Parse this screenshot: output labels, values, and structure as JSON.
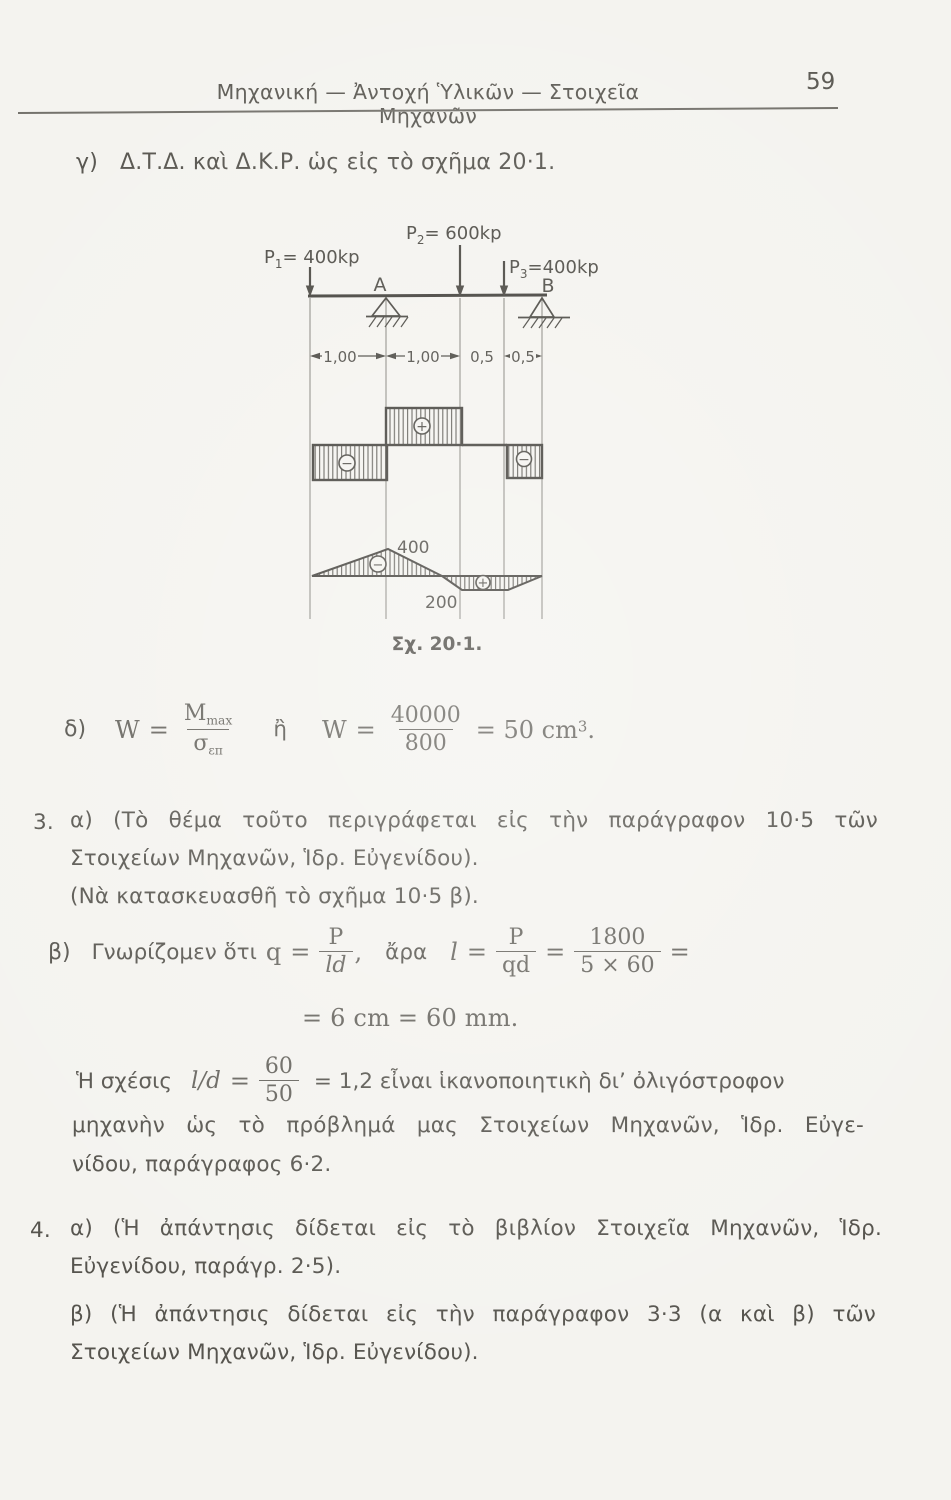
{
  "header": {
    "title": "Μηχανική — Ἀντοχή Ὑλικῶν — Στοιχεῖα Μηχανῶν",
    "page_number": "59"
  },
  "item_gamma": {
    "label": "γ)",
    "text": "Δ.Τ.Δ. καὶ Δ.Κ.Ρ. ὡς εἰς τὸ σχῆμα 20·1."
  },
  "figure": {
    "caption": "Σχ. 20·1.",
    "loads": [
      {
        "base": "P",
        "sub": "1",
        "value": "= 400kp"
      },
      {
        "base": "P",
        "sub": "2",
        "value": "= 600kp"
      },
      {
        "base": "P",
        "sub": "3",
        "value": "=400kp"
      }
    ],
    "supports": [
      "A",
      "B"
    ],
    "dims": [
      "1,00",
      "1,00",
      "0,5",
      "0,5"
    ],
    "shear_signs": [
      "−",
      "+",
      "−"
    ],
    "moment_signs": [
      "−",
      "+"
    ],
    "moment_values": {
      "max": "400",
      "mid": "200"
    }
  },
  "item_delta": {
    "label": "δ)",
    "w": "W",
    "eq": "=",
    "num1_base": "M",
    "num1_sub": "max",
    "den1_base": "σ",
    "den1_sub": "επ",
    "or_word": "ἢ",
    "w2": "W",
    "eq2": "=",
    "num2": "40000",
    "den2": "800",
    "result": "= 50 cm",
    "result_sup": "3",
    "result_end": "."
  },
  "section3": {
    "number": "3.",
    "line1": "α) (Τὸ θέμα τοῦτο περιγράφεται εἰς τὴν παράγραφον 10·5 τῶν",
    "line2": "Στοιχείων Μηχανῶν, Ἱδρ. Εὐγενίδου).",
    "line3": "(Νὰ κατασκευασθῆ τὸ σχῆμα 10·5 β)."
  },
  "item_beta3": {
    "label": "β)",
    "intro": "Γνωρίζομεν ὅτι",
    "q": "q",
    "eq": "=",
    "p1": "P",
    "ld": "ld",
    "comma": ",",
    "ara": "ἄρα",
    "l": "l",
    "eq2": "=",
    "p2": "P",
    "qd": "qd",
    "eq3": "=",
    "num": "1800",
    "den": "5 × 60",
    "eq4": "=",
    "line2": "= 6 cm = 60 mm."
  },
  "ratio_para": {
    "lead": "Ἡ σχέσις",
    "lhs": "l/d",
    "eq": "=",
    "num": "60",
    "den": "50",
    "rest": "= 1,2 εἶναι ἱκανοποιητικὴ δι’ ὀλιγόστροφον",
    "line2": "μηχανὴν ὡς τὸ πρόβλημά μας Στοιχείων Μηχανῶν, Ἱδρ. Εὐγε-",
    "line3": "νίδου, παράγραφος 6·2."
  },
  "section4": {
    "number": "4.",
    "a_line1": "α) (Ἡ ἀπάντησις δίδεται εἰς τὸ βιβλίον Στοιχεῖα Μηχανῶν, Ἱδρ.",
    "a_line2": "Εὐγενίδου, παράγρ. 2·5).",
    "b_line1": "β) (Ἡ ἀπάντησις δίδεται εἰς τὴν παράγραφον 3·3 (α καὶ β) τῶν",
    "b_line2": "Στοιχείων Μηχανῶν, Ἱδρ. Εὐγενίδου)."
  }
}
